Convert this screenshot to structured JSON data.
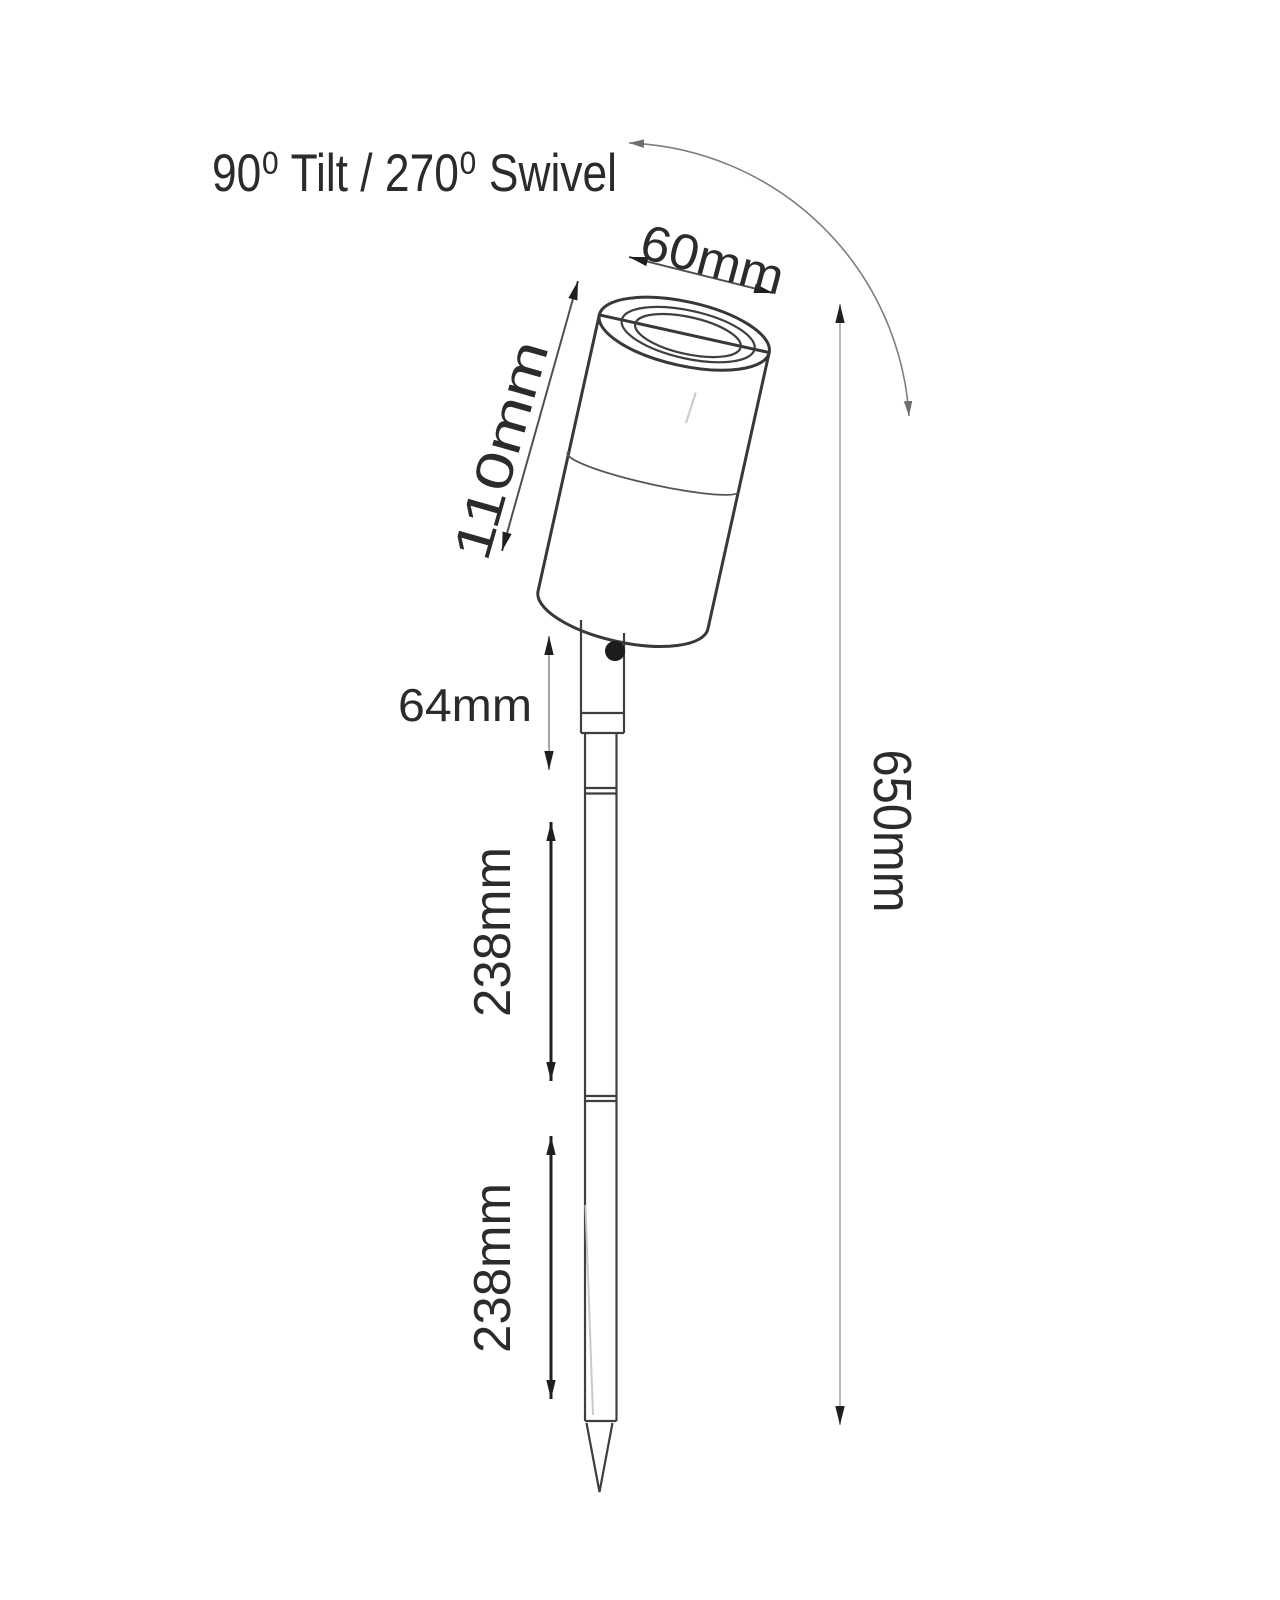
{
  "diagram": {
    "title": "90⁰ Tilt / 270⁰ Swivel",
    "dimensions": {
      "head_diameter": "60mm",
      "head_length": "110mm",
      "stem_length": "64mm",
      "spike_upper_length": "238mm",
      "spike_lower_length": "238mm",
      "overall_height": "650mm"
    },
    "colors": {
      "ink": "#2b2b2b",
      "outline": "#3a3a3a",
      "dim_dark": "#1f1f1f",
      "dim_gray": "#a8a8a8",
      "background": "#ffffff"
    }
  }
}
